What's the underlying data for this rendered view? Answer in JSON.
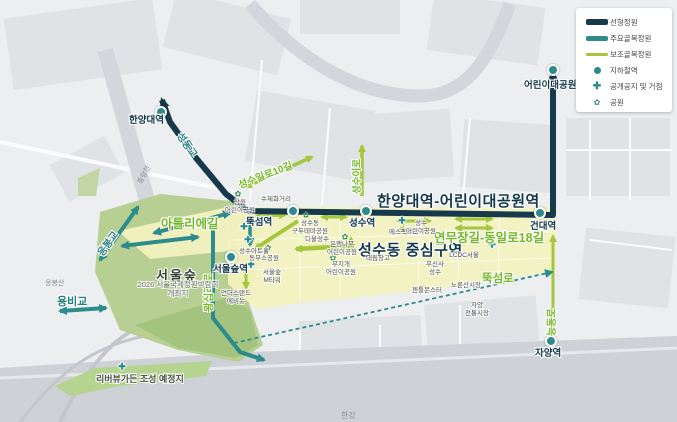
{
  "colors": {
    "linear_garden": "#16394b",
    "major_alley_garden": "#2d8b8b",
    "minor_alley_garden": "#a5c73d",
    "forest_green": "#b7cf92",
    "zone_yellow": "#f2f1c0"
  },
  "legend": {
    "items": [
      {
        "label": "선형정원",
        "type": "line-navy"
      },
      {
        "label": "주요골목정원",
        "type": "line-teal"
      },
      {
        "label": "보조골목정원",
        "type": "line-green"
      },
      {
        "label": "지하철역",
        "type": "dot"
      },
      {
        "label": "공개공지 및 거점",
        "type": "plus"
      },
      {
        "label": "공원",
        "type": "flower"
      }
    ]
  },
  "map": {
    "stations": {
      "hanyang": "한양대역",
      "ttukseom": "뚝섬역",
      "seongsu": "성수역",
      "seoulsup": "서울숲역",
      "kondae": "건대역",
      "childrens": "어린이대공원역",
      "jayang": "자양역"
    },
    "corridors": {
      "main_title": "한양대역-어린이대공원역",
      "district_title": "성수동 중심구역",
      "yeonmu": "연무장길-동일로18길",
      "atelier": "아틀리에길",
      "ttukseom_ro": "뚝섬로",
      "wangsimni_ro": "왕십리로",
      "neungdong_ro": "능동로",
      "seongsu_il_ro_10": "성수일로10길",
      "seongsu_i_ro": "성수이로"
    },
    "bridges": {
      "seongdong": "성동교",
      "eungbong": "응봉교",
      "yongbi": "용비교"
    },
    "areas": {
      "seoul_forest": "서울숲",
      "expo": "2026 서울국제정원박람회\n개최지",
      "riverview": "리버뷰가든 조성 예정지",
      "hangang": "한강",
      "jungnangcheon": "중랑천",
      "eungbongsan": "응봉산"
    },
    "pois": {
      "sangwon": "상원\n어린이공원",
      "sujehwa": "수제화거리",
      "gudutema": "성수동\n구두테마공원",
      "dior": "디올성수",
      "eunhaengnamu": "은행나무\n어린이공원",
      "mujigae": "무지개\n어린이공원",
      "artshall": "성수아트홀",
      "dongbu": "동부소공원",
      "mtower": "서울숲\nM타워",
      "understand": "언더스탠드\n에비뉴",
      "sfactory": "에스팩토리",
      "seongsu_child": "성수\n어린이공원",
      "daelim": "대림창고",
      "musinsa": "무신사\n성수",
      "lcdc": "LCDC서울",
      "gentlemonster": "젠틀몬스터",
      "norunsan": "노룬산시장",
      "jayang_market": "자양\n전통시장"
    }
  }
}
